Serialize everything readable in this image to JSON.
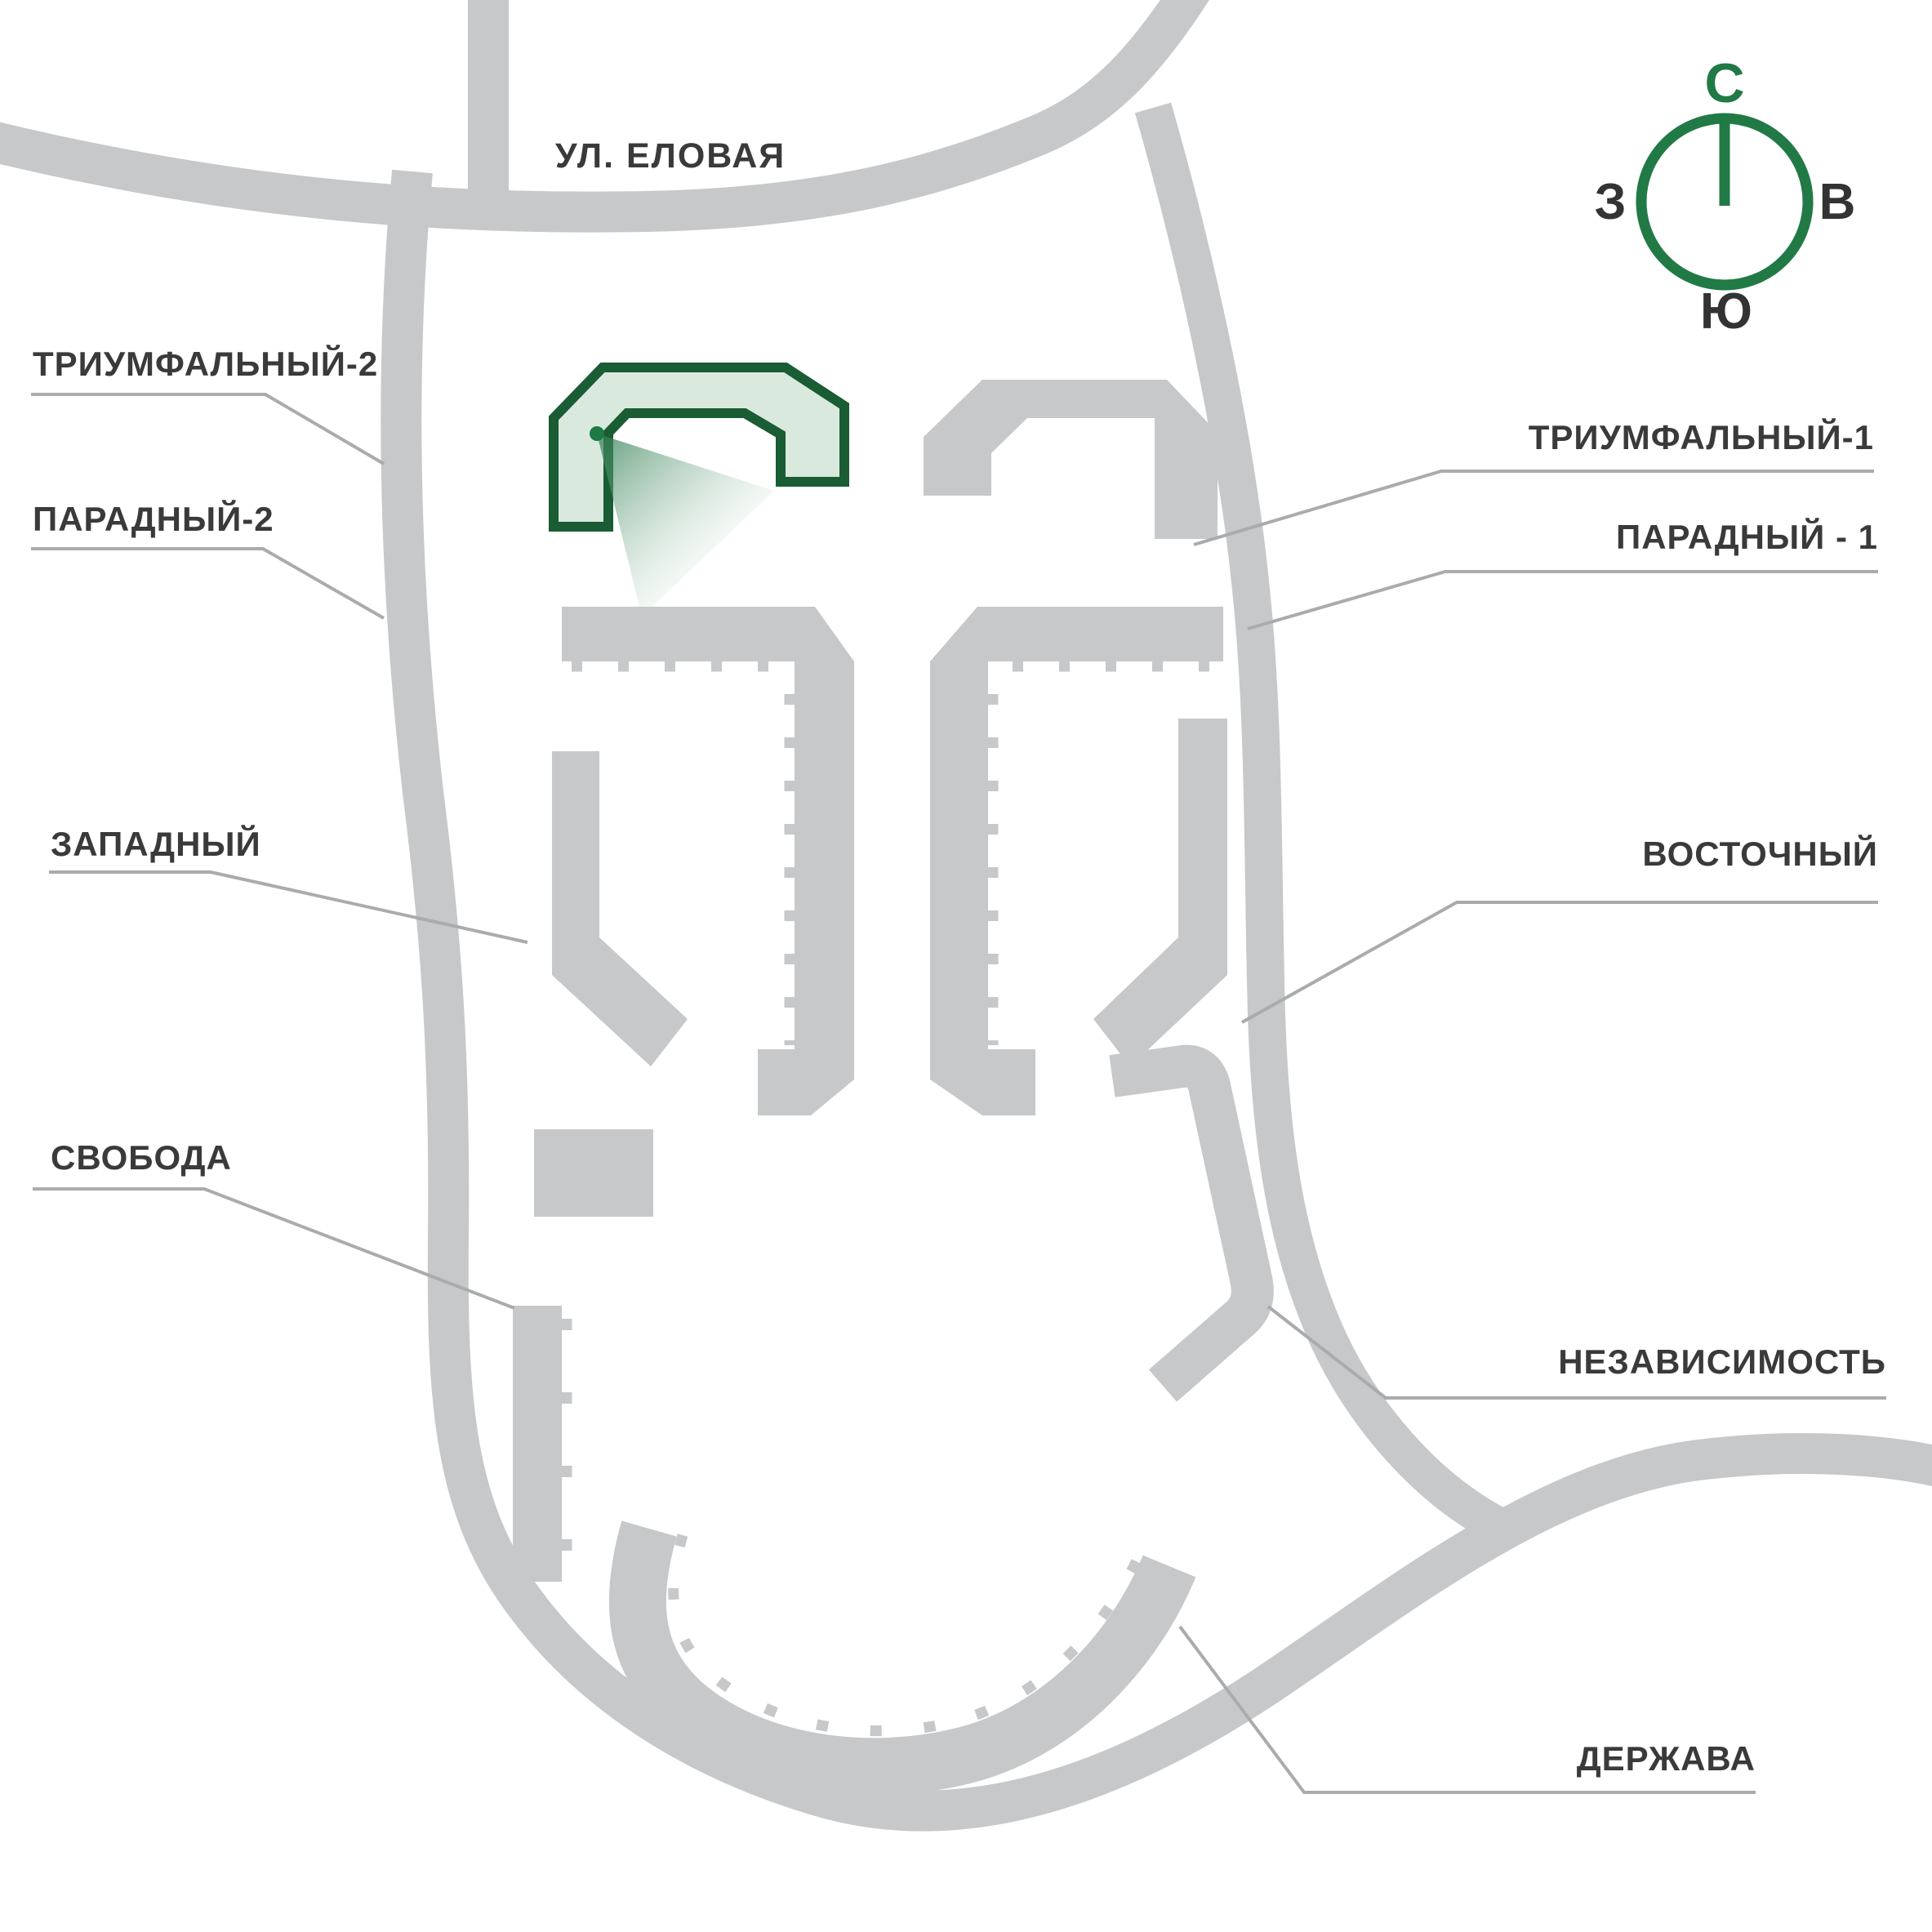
{
  "map": {
    "street_label": "УЛ. ЕЛОВАЯ",
    "highlighted_building": "ТРИУМФАЛЬНЫЙ-2",
    "labels": {
      "triumfalny2": "ТРИУМФАЛЬНЫЙ-2",
      "paradny2": "ПАРАДНЫЙ-2",
      "zapadny": "ЗАПАДНЫЙ",
      "svoboda": "СВОБОДА",
      "triumfalny1": "ТРИУМФАЛЬНЫЙ-1",
      "paradny1": "ПАРАДНЫЙ - 1",
      "vostochny": "ВОСТОЧНЫЙ",
      "nezavisimost": "НЕЗАВИСИМОСТЬ",
      "derzhava": "ДЕРЖАВА"
    },
    "compass": {
      "north": "С",
      "west": "З",
      "east": "В",
      "south": "Ю"
    },
    "colors": {
      "road_and_buildings": "#c6c8ca",
      "highlight_fill": "#d9e9de",
      "highlight_stroke": "#1a5c33",
      "compass_green": "#217a45",
      "label_text": "#3a3a3a",
      "leader_line": "#a9abad",
      "background": "#ffffff"
    }
  }
}
